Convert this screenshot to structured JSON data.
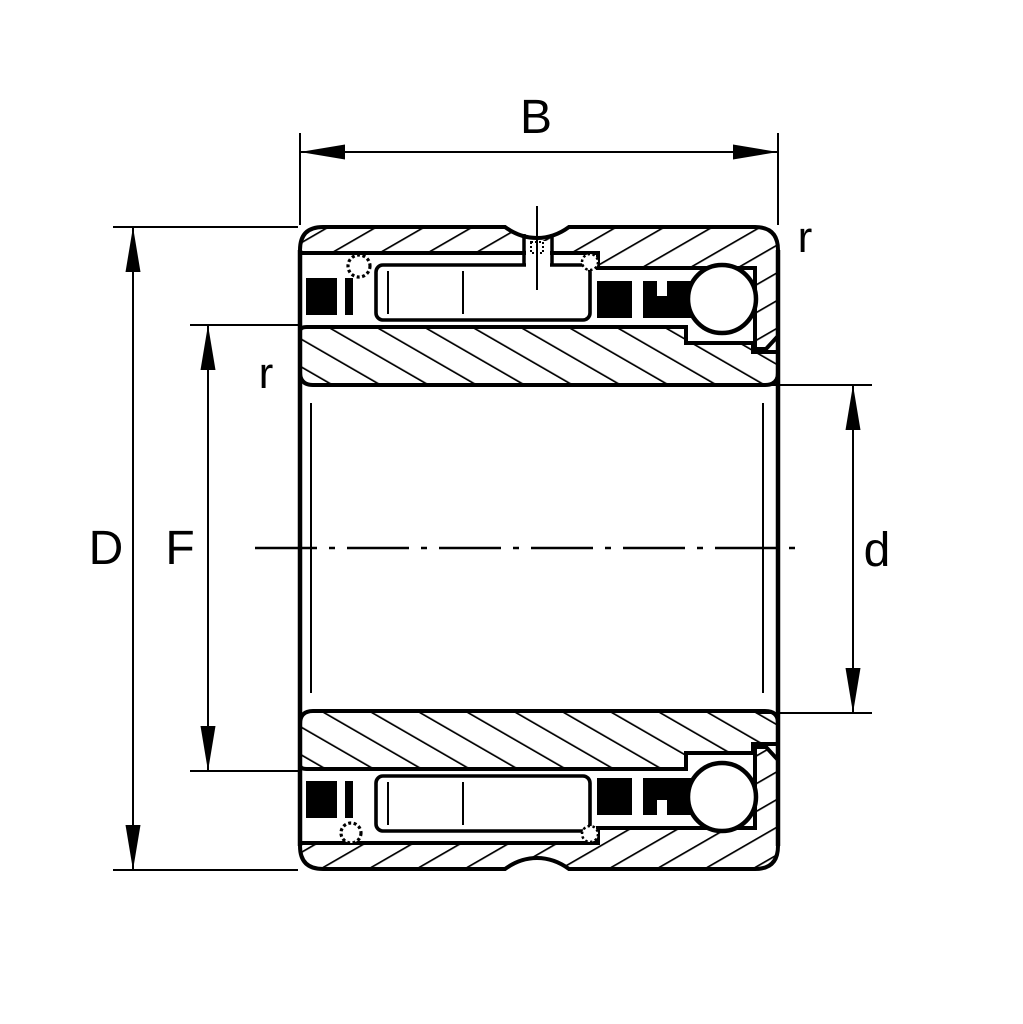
{
  "drawing": {
    "kind": "bearing-cross-section-technical-drawing",
    "description": "Combined needle roller / angular contact ball bearing, sectional view with dimension annotations",
    "labels": {
      "width": "B",
      "outer_diameter": "D",
      "inner_raceway_diameter": "F",
      "bore_diameter": "d",
      "chamfer_left": "r",
      "chamfer_right": "r"
    },
    "style": {
      "line_color": "#000000",
      "background": "#ffffff"
    }
  }
}
